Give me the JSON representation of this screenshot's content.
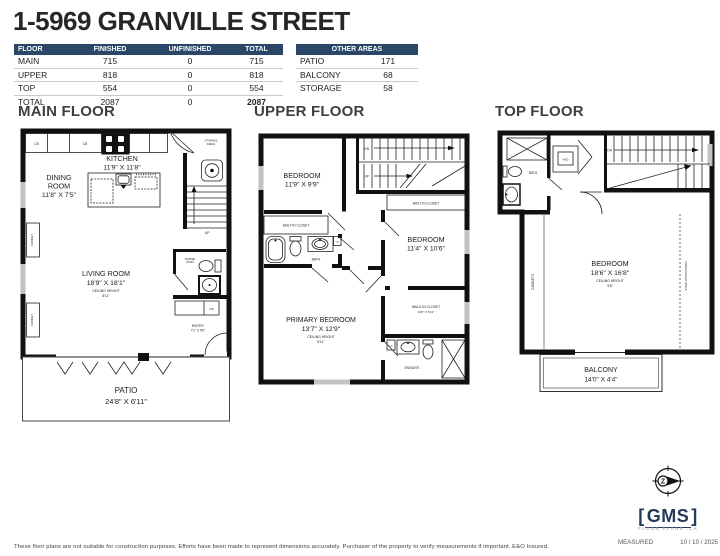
{
  "title": "1-5969 GRANVILLE STREET",
  "colors": {
    "table_header_bg": "#2b4768",
    "wall_color": "#111111",
    "logo_navy": "#233a58"
  },
  "area_table": {
    "headers": [
      "FLOOR",
      "FINISHED",
      "UNFINISHED",
      "TOTAL"
    ],
    "rows": [
      {
        "floor": "MAIN",
        "finished": "715",
        "unfinished": "0",
        "total": "715"
      },
      {
        "floor": "UPPER",
        "finished": "818",
        "unfinished": "0",
        "total": "818"
      },
      {
        "floor": "TOP",
        "finished": "554",
        "unfinished": "0",
        "total": "554"
      },
      {
        "floor": "TOTAL",
        "finished": "2087",
        "unfinished": "0",
        "total": "2087"
      }
    ]
  },
  "other_areas": {
    "header": "OTHER AREAS",
    "rows": [
      {
        "name": "PATIO",
        "value": "171"
      },
      {
        "name": "BALCONY",
        "value": "68"
      },
      {
        "name": "STORAGE",
        "value": "58"
      }
    ]
  },
  "floors": {
    "main": {
      "heading": "MAIN FLOOR",
      "kitchen_name": "KITCHEN",
      "kitchen_dims": "11'9\" X 11'8\"",
      "dining_l1": "DINING",
      "dining_l2": "ROOM",
      "dining_dims": "11'8\" X 7'5\"",
      "living_name": "LIVING ROOM",
      "living_dims": "18'9\" X 18'1\"",
      "ceiling_label": "CEILING HEIGHT",
      "living_ceiling": "8'11\"",
      "entry_name": "ENTRY",
      "entry_dims": "7'1\" X 5'0\"",
      "patio_name": "PATIO",
      "patio_dims": "24'8\" X 6'11\"",
      "powder_l1": "POWDER",
      "powder_l2": "ROOM",
      "storage_l1": "STORAGE",
      "storage_l2": "/MECH",
      "up": "UP",
      "cb": "CB",
      "cabinet": "CABINET"
    },
    "upper": {
      "heading": "UPPER FLOOR",
      "bedroom1_name": "BEDROOM",
      "bedroom1_dims": "11'9\" X 9'9\"",
      "bedroom2_name": "BEDROOM",
      "bedroom2_dims": "11'4\" X 10'6\"",
      "primary_name": "PRIMARY BEDROOM",
      "primary_dims": "13'7\" X 12'9\"",
      "ceiling_label": "CEILING HEIGHT",
      "primary_ceiling": "8'11\"",
      "built_in_closet": "BUILT-IN CLOSET",
      "walkin_name": "WALK-IN CLOSET",
      "walkin_dims": "10'6\" X 5'11\"",
      "bath": "BATH",
      "ensuite": "ENSUITE",
      "dn": "DN",
      "up": "UP",
      "cb": "CB"
    },
    "top": {
      "heading": "TOP FLOOR",
      "bedroom_name": "BEDROOM",
      "bedroom_dims": "18'6\" X 16'8\"",
      "ceiling_label": "CEILING HEIGHT",
      "bedroom_ceiling": "9'6\"",
      "balcony_name": "BALCONY",
      "balcony_dims": "14'0\" X 4'4\"",
      "bath": "BATH",
      "wd": "W/D",
      "dn": "DN",
      "cabinets": "CABINETS",
      "under_height": "UNDER HEIGHT SPACE"
    }
  },
  "footer": {
    "disclaimer": "These floor plans are not suitable for construction purposes. Efforts have been made to represent dimensions accurately.  Purchaser of the property to verify measurements if important.  E&O Insured.",
    "measured_label": "MEASURED",
    "measured_date": "10 / 10 / 2025"
  },
  "logo": {
    "bracket_l": "[",
    "name": "GMS",
    "bracket_r": "]",
    "sub": "FLOOR PLANS .CA",
    "compass_letter": "Z"
  }
}
